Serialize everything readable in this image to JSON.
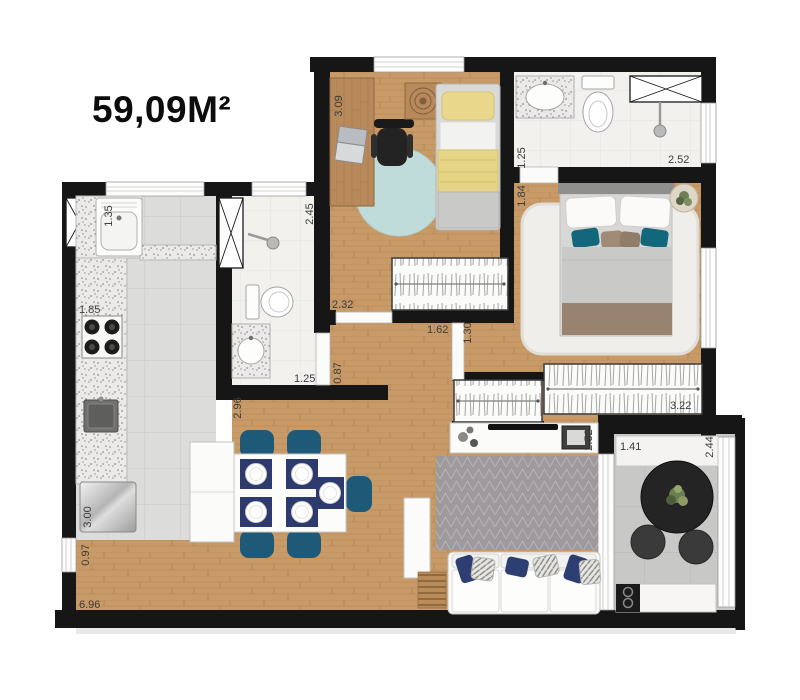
{
  "title": {
    "area_label": "59,09M²"
  },
  "palette": {
    "wall": "#161616",
    "wood_floor": "#c79a67",
    "kitchen_tile": "#dcdcda",
    "bath_tile": "#f2f1ee",
    "balcony_tile": "#c8c8c6",
    "chair_teal": "#1e5a78",
    "placemat_navy": "#2c3a6e",
    "pillow_navy": "#2c3e72",
    "accent_teal": "#13677c",
    "bed_yellow": "#e9d88c",
    "round_rug_blue": "#bfdbda",
    "living_rug_gray": "#9d9a9d"
  },
  "dimensions": {
    "kitchen_window": "1.35",
    "bedroom1_depth": "3.09",
    "suite_bath_width": "1.25",
    "suite_entry": "1.84",
    "suite_bath_length": "2.52",
    "social_bath_depth": "2.45",
    "kitchen_counter": "1.85",
    "hallway_length": "2.32",
    "hallway_opening": "1.62",
    "suite_door": "1.30",
    "social_bath_door": "0.87",
    "social_bath_width": "1.25",
    "kitchen_wall": "2.96",
    "kitchen_length": "3.00",
    "service_window": "0.97",
    "total_width": "6.96",
    "suite_wardrobe": "3.22",
    "living_width": "2.52",
    "balcony_width": "1.41",
    "balcony_depth": "2.44"
  }
}
